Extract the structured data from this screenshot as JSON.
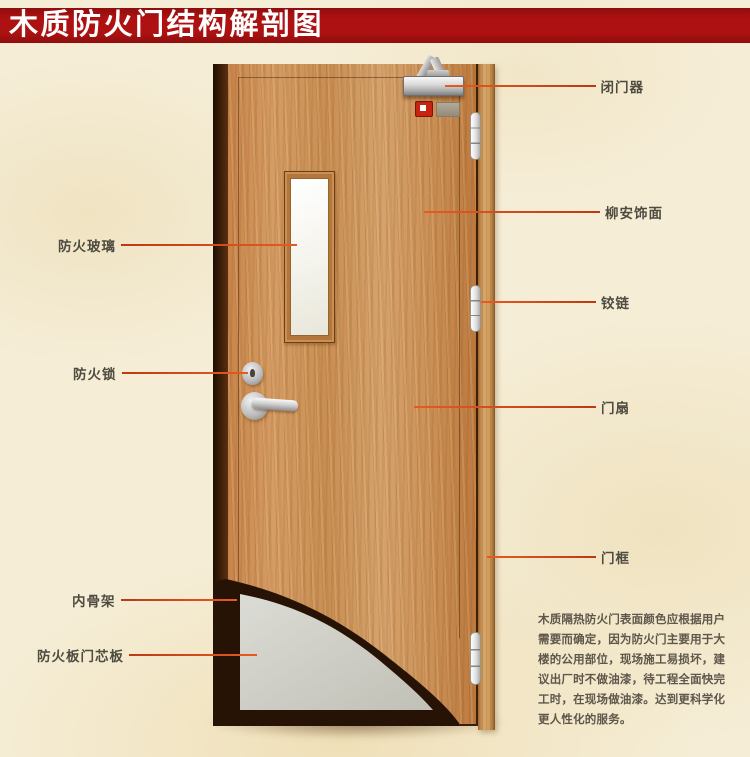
{
  "title": {
    "text": "木质防火门结构解剖图"
  },
  "labels": {
    "left": [
      {
        "text": "防火玻璃"
      },
      {
        "text": "防火锁"
      },
      {
        "text": "内骨架"
      },
      {
        "text": "防火板门芯板"
      }
    ],
    "right": [
      {
        "text": "闭门器"
      },
      {
        "text": "柳安饰面"
      },
      {
        "text": "铰链"
      },
      {
        "text": "门扇"
      },
      {
        "text": "门框"
      }
    ]
  },
  "paragraph": {
    "lines": [
      "木质隔热防火门表面颜色应根据用户",
      "需要而确定，因为防火门主要用于大",
      "楼的公用部位，现场施工易损坏，建",
      "议出厂时不做油漆，待工程全面快完",
      "工时，在现场做油漆。达到更科学化",
      "更人性化的服务。"
    ]
  },
  "colors": {
    "banner_red": "#ad1111",
    "background_cream": "#f5edd6",
    "door_wood": "#cd9257",
    "frame_wood": "#cf9a59",
    "door_edge_dark": "#3f2009",
    "core_gray": "#cfcfc7",
    "leader_line_orange": "#d84d1d",
    "label_text_gray": "#4e4b40",
    "paragraph_text": "#5e574b",
    "glass_white": "#f4f3ec",
    "metal_silver": "#c9c9c9",
    "alarm_red": "#c62310"
  }
}
